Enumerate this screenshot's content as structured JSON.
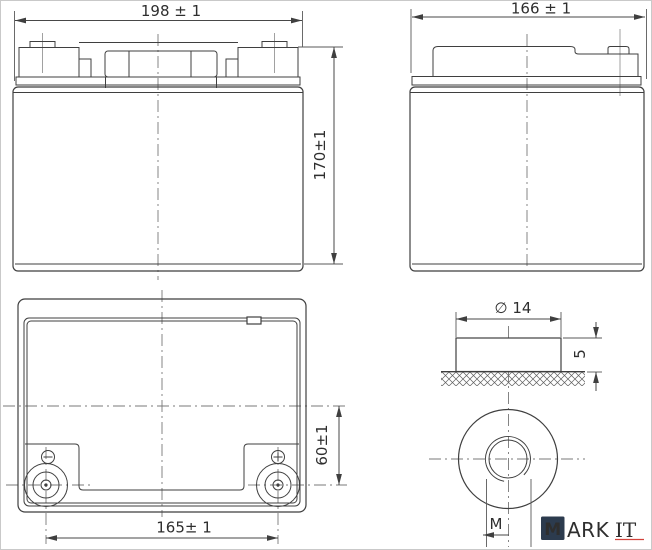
{
  "drawing": {
    "type": "battery-dimension-drawing",
    "views": {
      "front": {
        "label": "front-view",
        "dim_width": "198 ± 1",
        "dim_height": "170±1"
      },
      "side": {
        "label": "side-view",
        "dim_depth": "166 ± 1"
      },
      "top": {
        "label": "top-view",
        "dim_terminal_spacing": "165± 1",
        "dim_terminal_offset": "60±1",
        "negative_mark": "−",
        "positive_mark": "+"
      },
      "terminal_detail": {
        "label": "terminal-detail-view",
        "dim_diameter": "∅ 14",
        "dim_height": "5",
        "dim_thread": "M"
      }
    },
    "colors": {
      "line": "#3f3f3f",
      "centerline": "#787878",
      "text": "#2e2e2e"
    }
  },
  "watermark": {
    "badge_letter": "M",
    "name_sans": "ARK",
    "name_serif": "IT",
    "badge_color": "#2c3b4e",
    "text_color": "#e6463d"
  }
}
